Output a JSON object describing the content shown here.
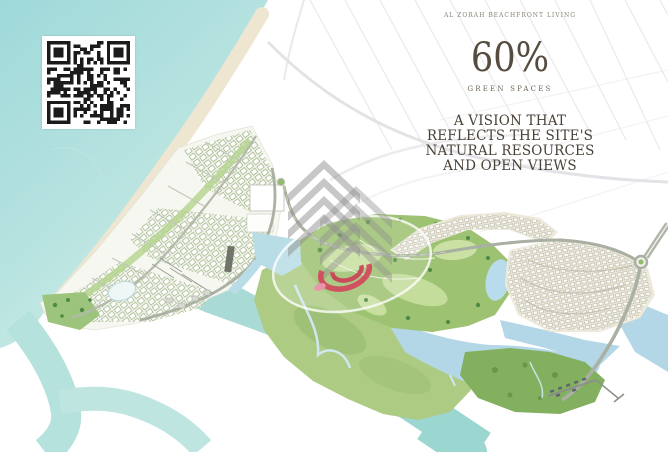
{
  "header": {
    "eyebrow": "AL ZORAH BEACHFRONT LIVING",
    "stat_value": "60%",
    "stat_label": "GREEN SPACES",
    "headline_lines": [
      "A VISION THAT",
      "REFLECTS THE SITE'S",
      "NATURAL RESOURCES",
      "AND OPEN VIEWS"
    ]
  },
  "colors": {
    "text": "#4a4237",
    "stat": "#554c3f",
    "muted": "#8a8276",
    "accent_red": "#d5465c",
    "sea": "#a6dcdb",
    "sea_light": "#d2ece8",
    "sand": "#eee6d0",
    "park_green": "#a5cc80",
    "golf_green": "#9cc272",
    "marsh_green": "#aecb84",
    "lagoon_blue": "#b3d7e7",
    "mangrove_green": "#83b05e",
    "road_gray": "#aab0a4",
    "cluster_tan": "#edeadb",
    "street_faint": "#e6e6ea",
    "watermark_gray": "#909090",
    "qr_dark": "#1b1b1b"
  },
  "icons": {
    "qr_code": "qr-code",
    "developer_watermark": "chevron-stack-logo",
    "agency_watermark": "red-swoosh-circle-logo"
  }
}
